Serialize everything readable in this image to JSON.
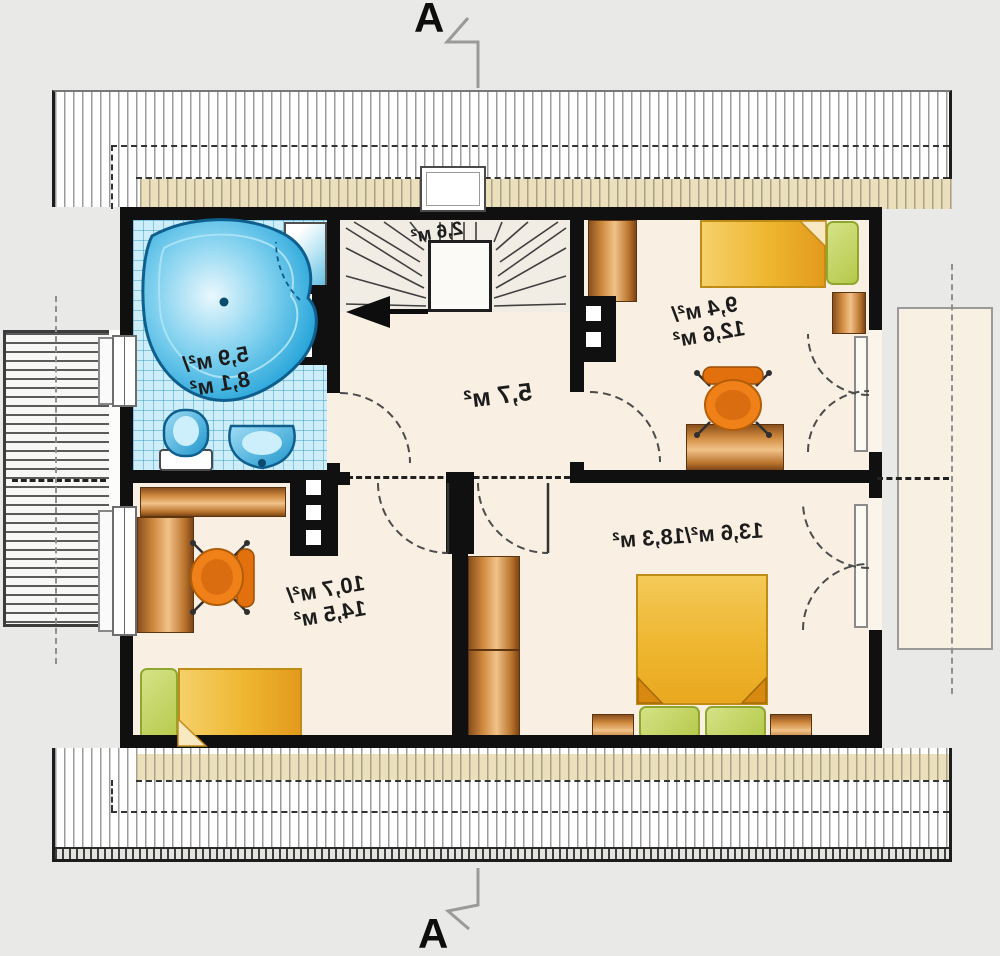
{
  "section_markers": {
    "top": "A",
    "bottom": "A"
  },
  "rooms": {
    "bathroom": {
      "area_line1": "5,9 м²/",
      "area_line2": "8,1 м²"
    },
    "staircase": {
      "area": "2,6 м²"
    },
    "hall": {
      "area": "5,7 м²"
    },
    "bedroom_ne": {
      "area_line1": "9,4 м²/",
      "area_line2": "12,6 м²"
    },
    "bedroom_sw": {
      "area_line1": "10,7 м²/",
      "area_line2": "14,5 м²"
    },
    "bedroom_se": {
      "area": "13,6 м²/18,3 м²"
    }
  },
  "furniture_icons": {
    "bathroom": [
      "corner-bathtub-icon",
      "shower-icon",
      "toilet-icon",
      "washbasin-icon"
    ],
    "staircase": [
      "winder-stairs-icon",
      "direction-arrow-icon",
      "roof-window-icon"
    ],
    "bedroom_ne": [
      "wardrobe-icon",
      "single-bed-icon",
      "pillow-icon",
      "nightstand-icon",
      "desk-icon",
      "office-chair-icon"
    ],
    "bedroom_sw": [
      "wardrobe-icon",
      "desk-icon",
      "office-chair-icon",
      "single-bed-icon",
      "pillow-icon"
    ],
    "bedroom_se": [
      "wardrobe-icon",
      "double-bed-icon",
      "pillow-icon",
      "pillow-icon",
      "nightstand-icon",
      "nightstand-icon"
    ]
  },
  "colors": {
    "wall": "#101010",
    "floor": "#f9efe3",
    "bath_tile": "#cdeef9",
    "fixture_blue": "#2fa9dc",
    "bed_yellow": "#eeb62f",
    "pillow_green": "#c6d765",
    "wood": "#cf8a3e",
    "chair_orange": "#ee7c15",
    "roof_hatch_line": "#9b9b9b",
    "eaves_cream": "#ecdfbc",
    "deck_line": "#5a5a5a",
    "section_line": "#9a9a9a",
    "label_text": "#1c1c1c"
  }
}
